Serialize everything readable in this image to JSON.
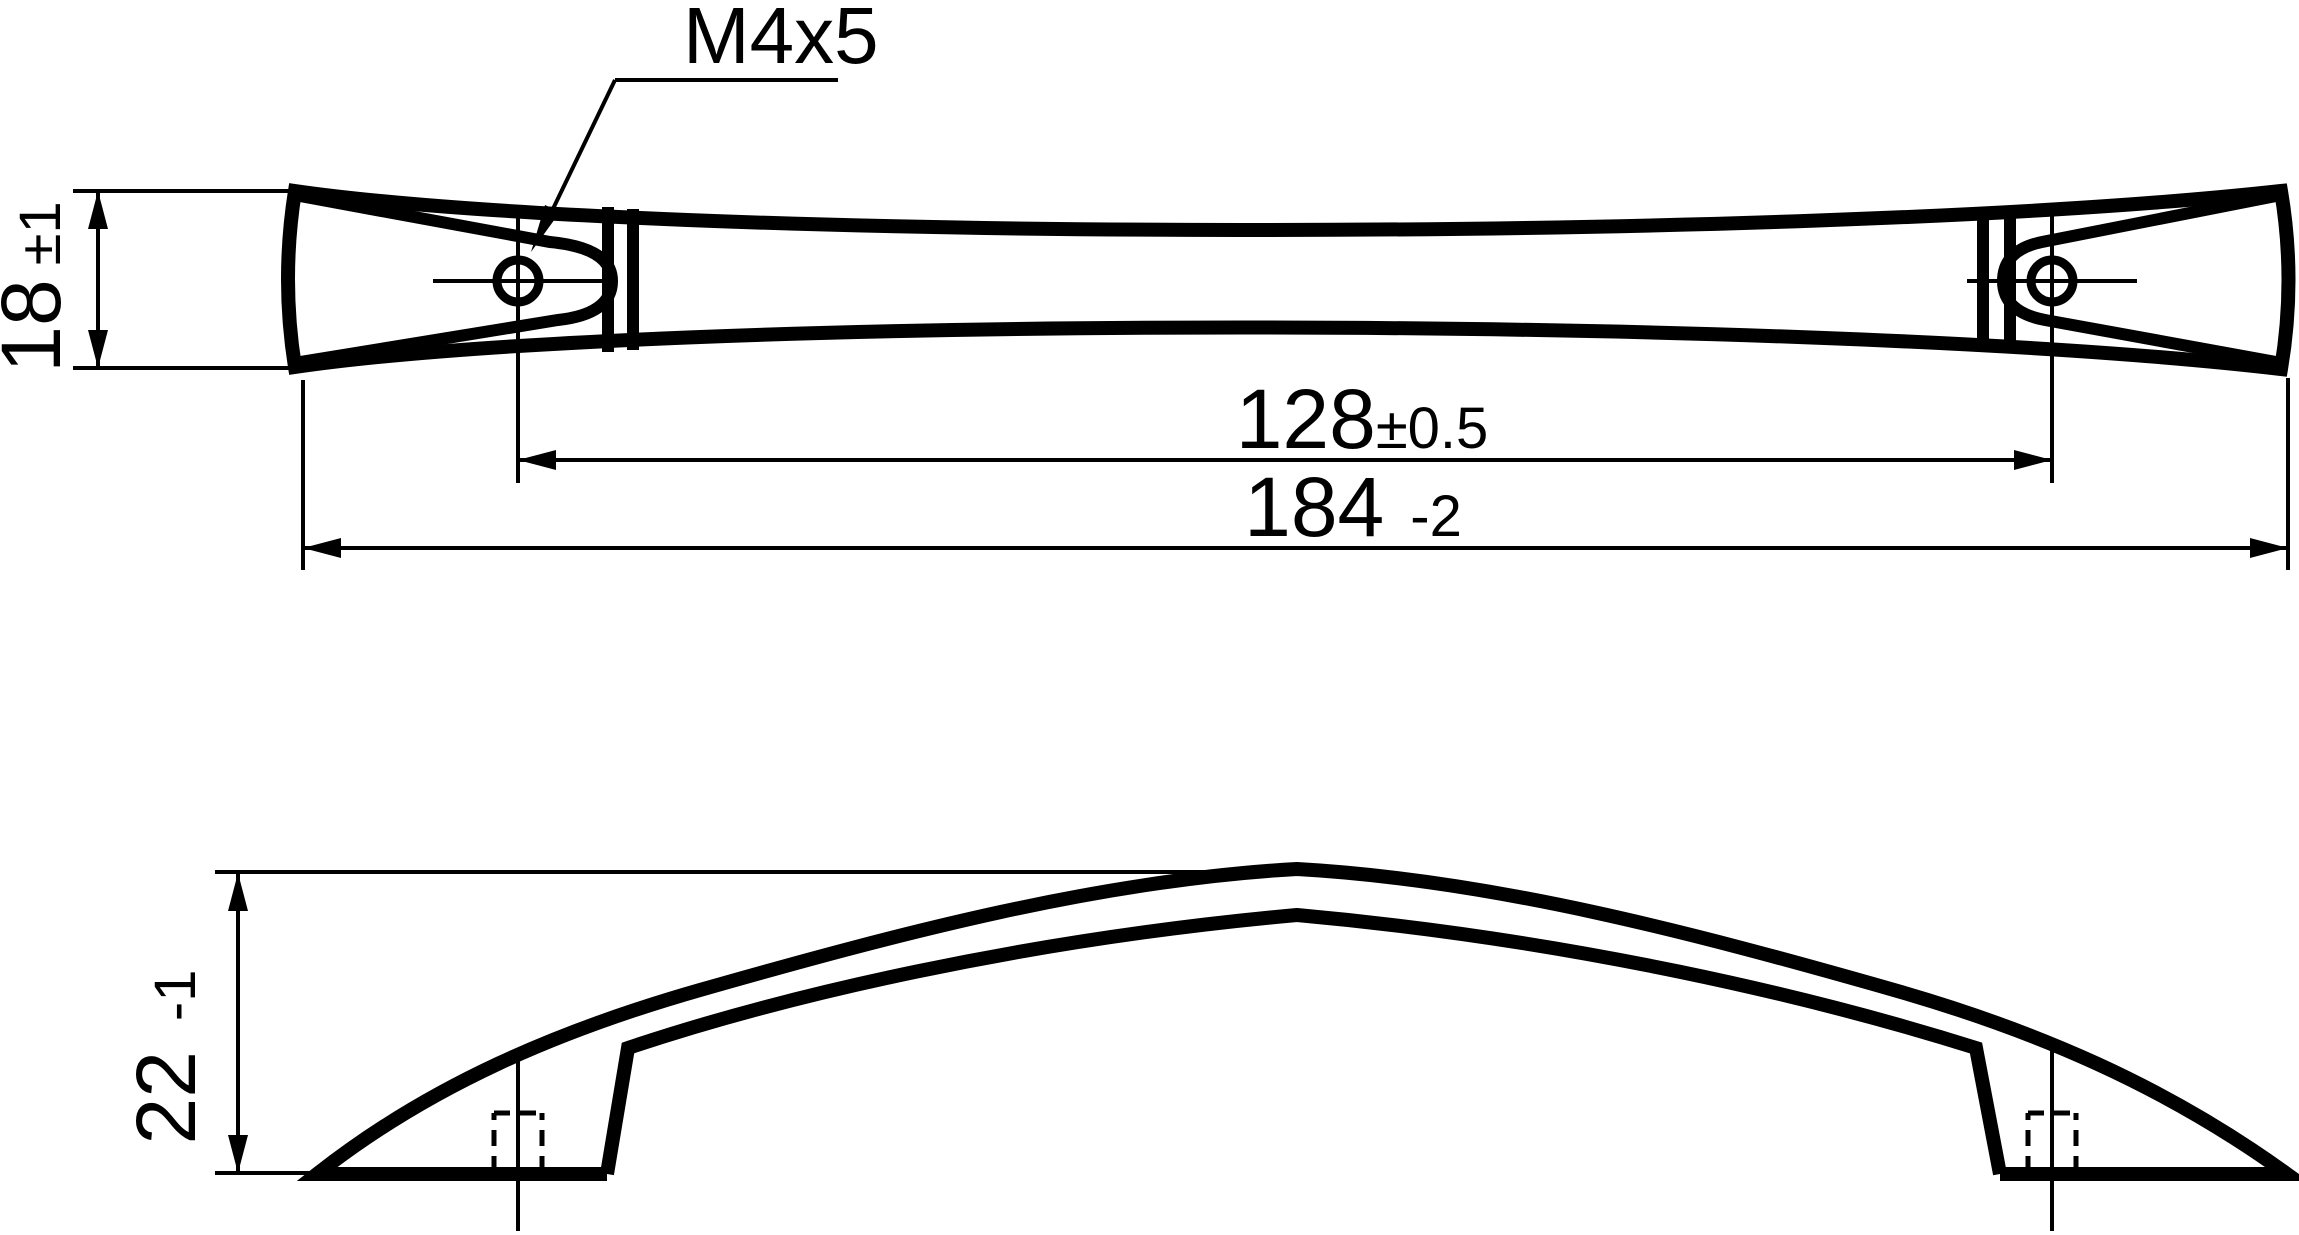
{
  "drawing": {
    "thread_callout": "M4x5",
    "dimensions": {
      "hole_spacing": {
        "value": "128",
        "tolerance": "±0.5"
      },
      "overall_length": {
        "value": "184",
        "tolerance": "-2"
      },
      "end_height": {
        "value": "18",
        "tolerance": "±1"
      },
      "handle_height": {
        "value": "22",
        "tolerance": "-1"
      }
    },
    "colors": {
      "line": "#000000",
      "background": "#ffffff"
    }
  }
}
